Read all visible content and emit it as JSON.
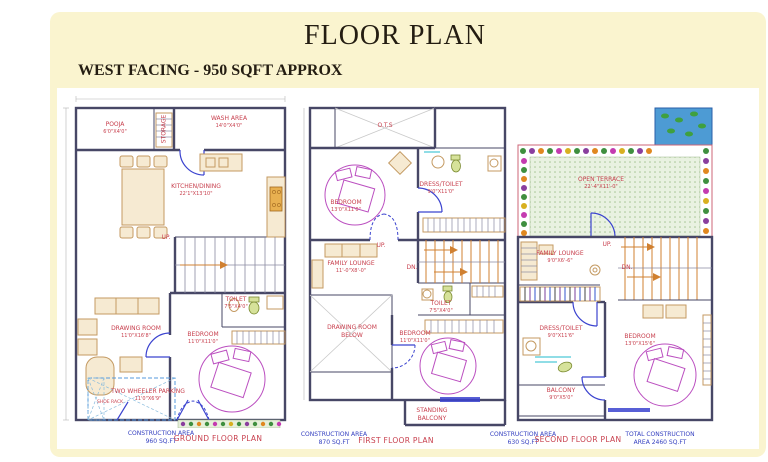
{
  "header": {
    "title": "FLOOR PLAN",
    "subtitle": "WEST FACING - 950 SQFT APPROX"
  },
  "colors": {
    "panel_background": "#FAF4CF",
    "room_label_red": "#C8404E",
    "construction_label_blue": "#3540C0",
    "wall": "#474766",
    "door_blue": "#3b43cf",
    "stair_orange": "#d08030",
    "bed_magenta": "#bb4fc0",
    "pond_blue": "#4d9bd4",
    "terrace_green": "#e9f2e1"
  },
  "plans": [
    {
      "id": "ground-floor",
      "rooms": {
        "pooja": {
          "name": "POOJA",
          "dims": "6'0\"X4'0\""
        },
        "storage": {
          "name": "STORAGE"
        },
        "wash": {
          "name": "WASH AREA",
          "dims": "14'0\"X4'0\""
        },
        "kitchen": {
          "name": "KITCHEN/DINING",
          "dims": "22'1\"X13'10\""
        },
        "up": {
          "name": "UP."
        },
        "toilet": {
          "name": "TOILET",
          "dims": "7'5\"X4'0\""
        },
        "drawing": {
          "name": "DRAWING ROOM",
          "dims": "11'0\"X16'8\""
        },
        "bedroom": {
          "name": "BEDROOM",
          "dims": "11'0\"X11'0\""
        },
        "parking": {
          "name": "TWO WHEELER PARKING",
          "dims": "11'0\"X6'9\""
        },
        "shoerack": {
          "name": "SHOE RACK"
        }
      },
      "footer": {
        "area_line1": "CONSTRUCTION AREA",
        "area_line2": "960 SQ.FT",
        "plan_name": "GROUND FLOOR PLAN"
      }
    },
    {
      "id": "first-floor",
      "rooms": {
        "ots": {
          "name": "O.T.S"
        },
        "bedroom1": {
          "name": "BEDROOM",
          "dims": "13'0\"X11'0\""
        },
        "dress_toilet": {
          "name": "DRESS/TOILET",
          "dims": "9'0\"X11'0\""
        },
        "family_lounge": {
          "name": "FAMILY LOUNGE",
          "dims": "11'-0\"X8'-0\""
        },
        "up": {
          "name": "UP."
        },
        "dn": {
          "name": "DN."
        },
        "toilet": {
          "name": "TOILET",
          "dims": "7'5\"X4'0\""
        },
        "drawing_below": {
          "name": "DRAWING ROOM",
          "dims": "BELOW"
        },
        "bedroom2": {
          "name": "BEDROOM",
          "dims": "11'0\"X11'0\""
        },
        "balcony": {
          "name": "STANDING",
          "dims": "BALCONY"
        }
      },
      "footer": {
        "area_line1": "CONSTRUCTION AREA",
        "area_line2": "870 SQ.FT",
        "plan_name": "FIRST FLOOR PLAN"
      }
    },
    {
      "id": "second-floor",
      "rooms": {
        "terrace": {
          "name": "OPEN TERRACE",
          "dims": "22'-4\"X11'-0\""
        },
        "family_lounge": {
          "name": "FAMILY LOUNGE",
          "dims": "9'0\"X6'-6\""
        },
        "up": {
          "name": "UP."
        },
        "dn": {
          "name": "DN."
        },
        "dress_toilet": {
          "name": "DRESS/TOILET",
          "dims": "9'0\"X11'6\""
        },
        "bedroom": {
          "name": "BEDROOM",
          "dims": "13'0\"X15'6\""
        },
        "balcony": {
          "name": "BALCONY",
          "dims": "9'0\"X5'0\""
        }
      },
      "footer": {
        "area_line1": "CONSTRUCTION AREA",
        "area_line2": "630 SQ.FT",
        "plan_name": "SECOND FLOOR PLAN"
      },
      "total": {
        "line1": "TOTAL CONSTRUCTION",
        "line2": "AREA  2460 SQ.FT"
      }
    }
  ]
}
